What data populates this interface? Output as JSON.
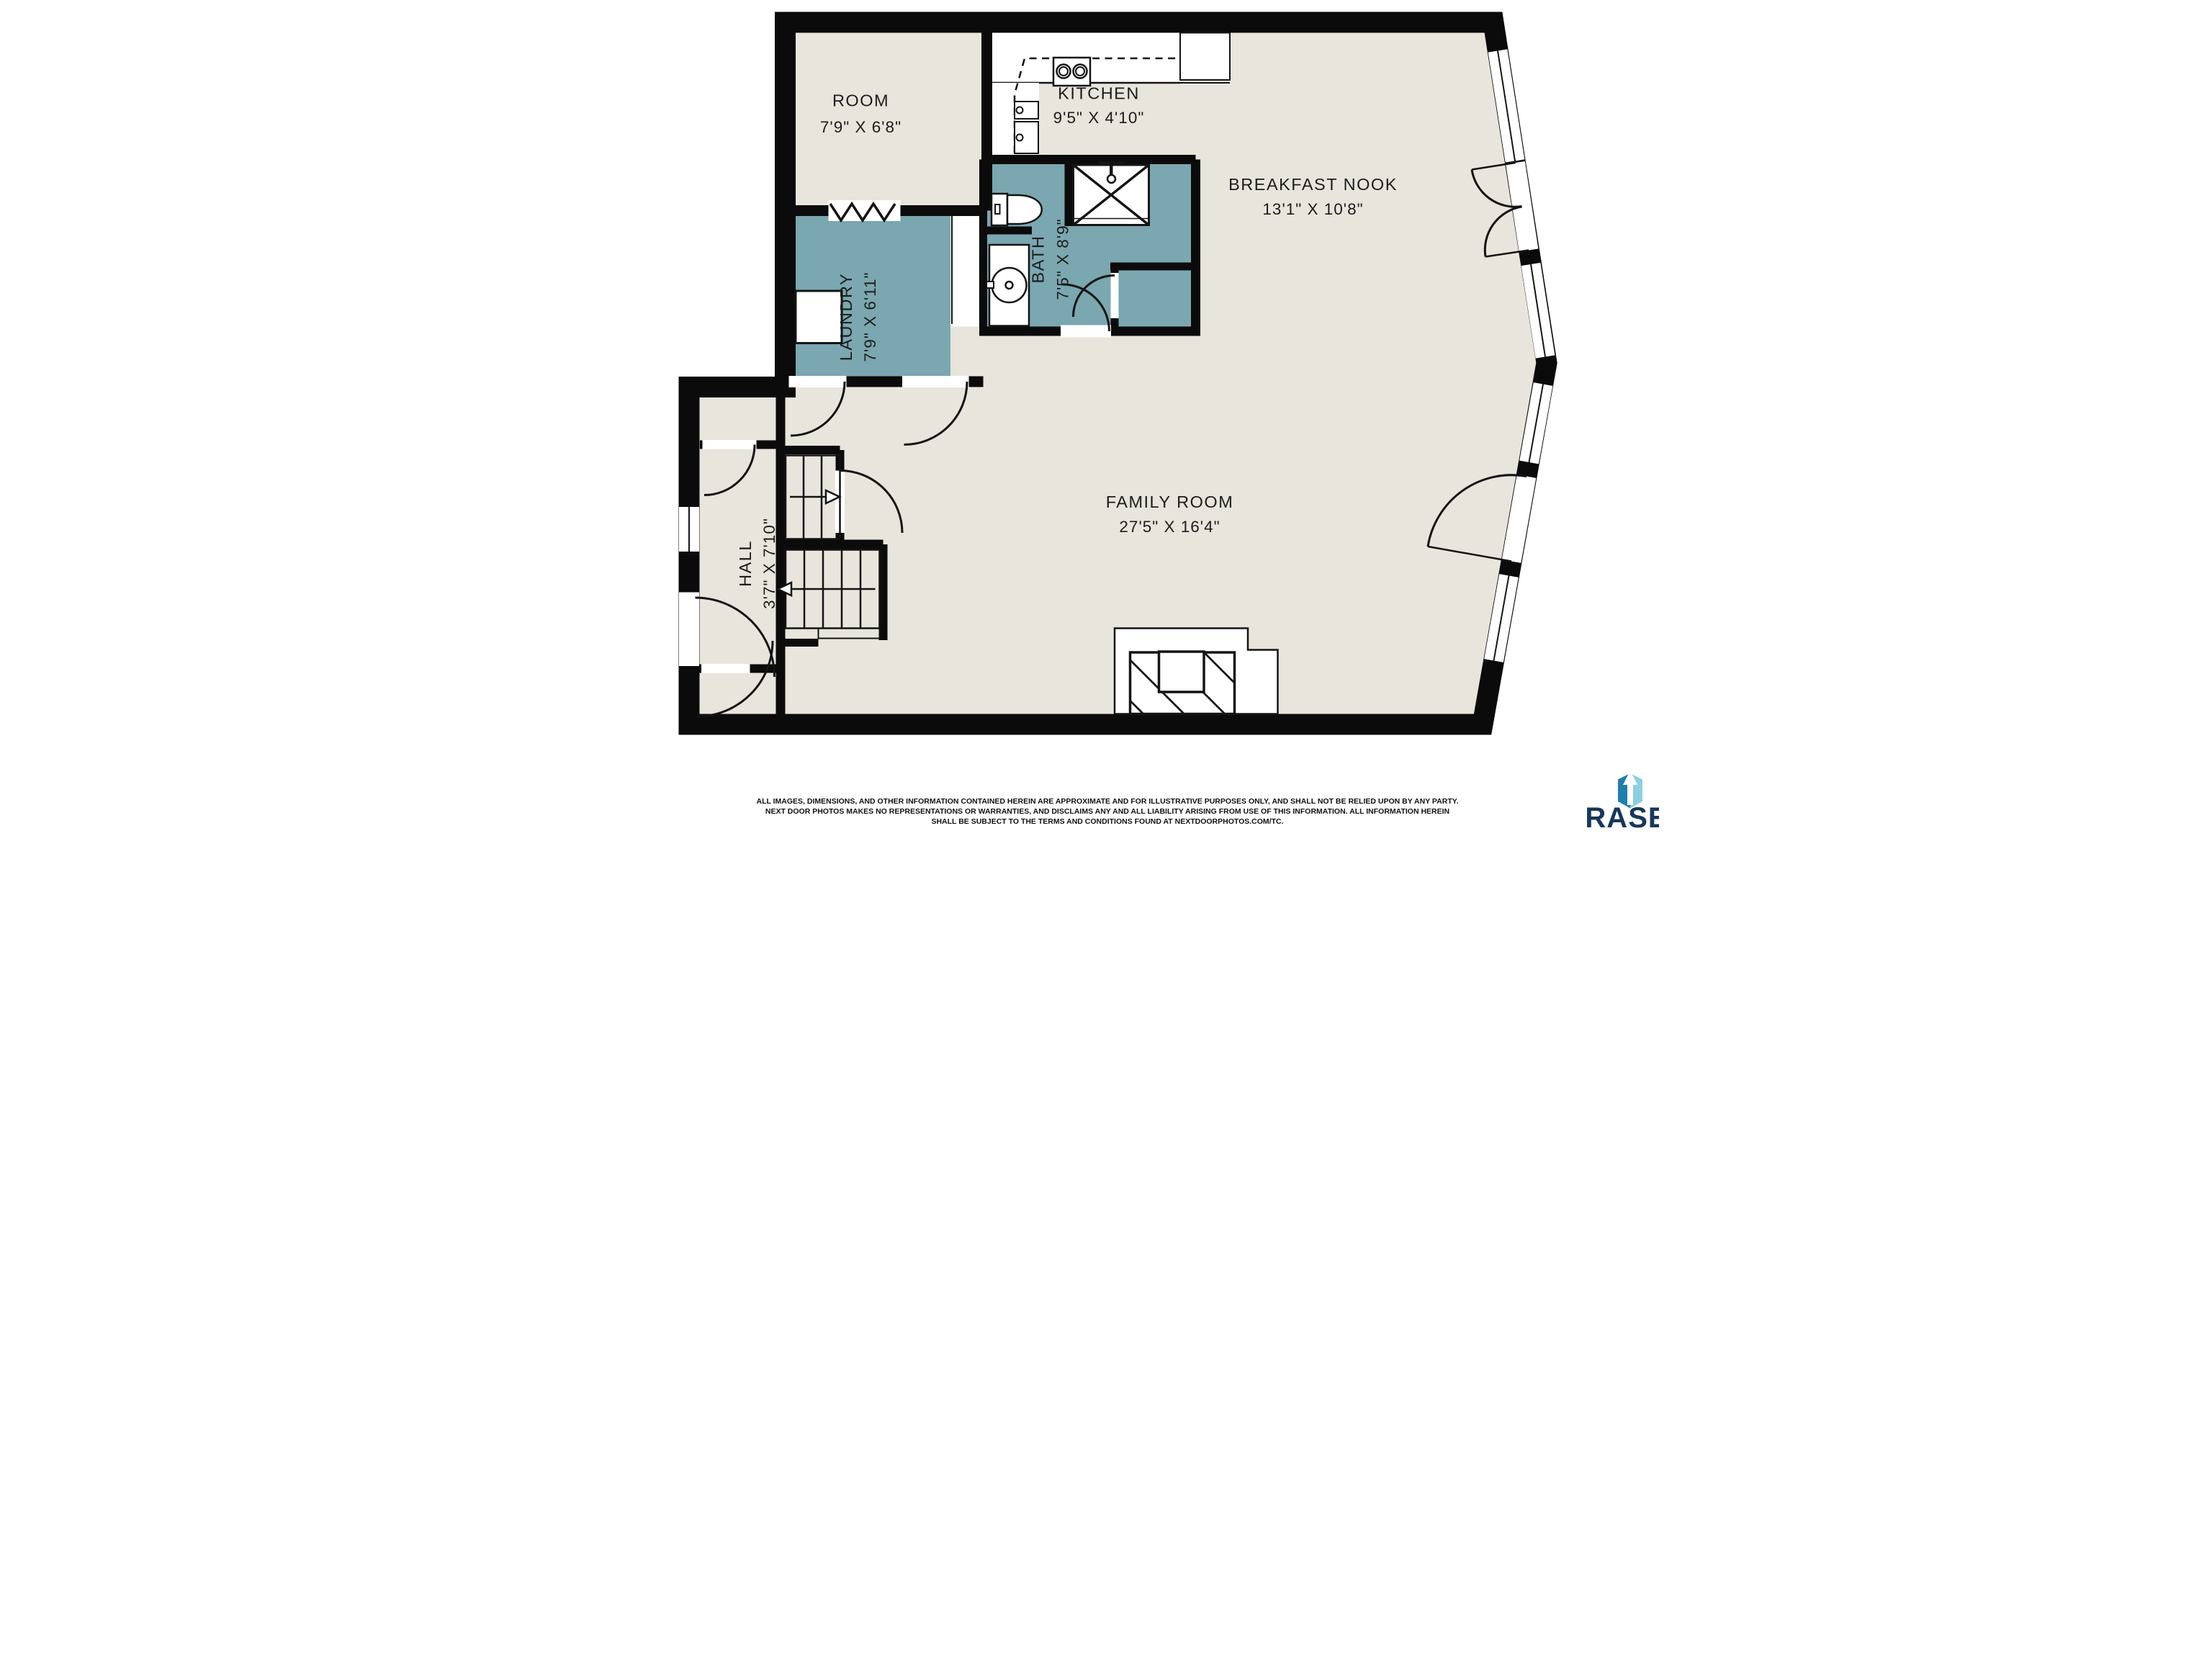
{
  "plan": {
    "colors": {
      "floor": "#e7e5dc",
      "wet_room": "#7aa7b0",
      "wall": "#0b0b0b",
      "background": "#ffffff"
    },
    "rooms": [
      {
        "id": "room",
        "name": "ROOM",
        "dimensions": "7'9\" X 6'8\""
      },
      {
        "id": "kitchen",
        "name": "KITCHEN",
        "dimensions": "9'5\" X 4'10\""
      },
      {
        "id": "breakfast-nook",
        "name": "BREAKFAST NOOK",
        "dimensions": "13'1\" X 10'8\""
      },
      {
        "id": "laundry",
        "name": "LAUNDRY",
        "dimensions": "7'9\" X 6'11\""
      },
      {
        "id": "bath",
        "name": "BATH",
        "dimensions": "7'5\" X 8'9\""
      },
      {
        "id": "hall",
        "name": "HALL",
        "dimensions": "3'7\" X 7'10\""
      },
      {
        "id": "family-room",
        "name": "FAMILY ROOM",
        "dimensions": "27'5\" X 16'4\""
      }
    ],
    "symbols": [
      "stairs-up-arrow",
      "stairs-down-arrow",
      "accordion-door",
      "shower",
      "toilet",
      "sink",
      "cooktop",
      "fireplace"
    ]
  },
  "footer": {
    "disclaimer_lines": [
      "ALL IMAGES, DIMENSIONS, AND OTHER INFORMATION CONTAINED HEREIN ARE APPROXIMATE AND FOR ILLUSTRATIVE PURPOSES ONLY, AND SHALL NOT BE RELIED UPON BY ANY PARTY.",
      "NEXT DOOR PHOTOS MAKES NO REPRESENTATIONS OR WARRANTIES, AND DISCLAIMS ANY AND ALL LIABILITY ARISING FROM USE OF THIS INFORMATION. ALL INFORMATION HEREIN",
      "SHALL BE SUBJECT TO THE TERMS AND CONDITIONS FOUND AT NEXTDOORPHOTOS.COM/TC."
    ]
  },
  "logo": {
    "text": "RASE",
    "colors": {
      "dark_panel": "#1d7fae",
      "light_panel": "#8bd0e2",
      "text": "#17375c"
    }
  }
}
